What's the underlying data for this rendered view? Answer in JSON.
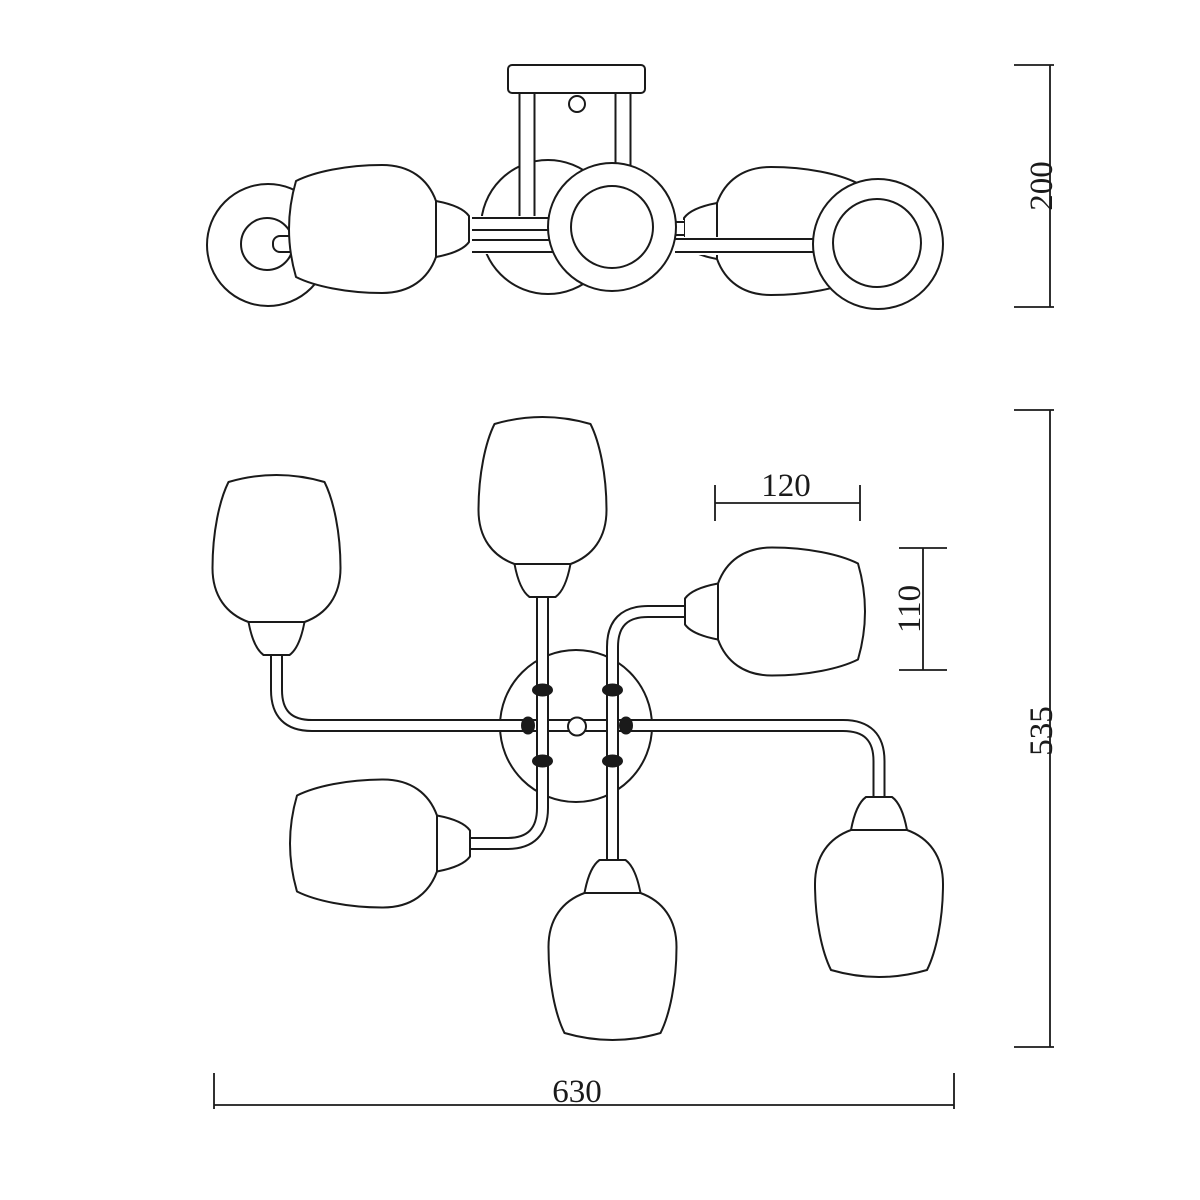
{
  "drawing": {
    "type": "technical-dimension-drawing",
    "subject": "6-light ceiling chandelier, side elevation (top) and plan view (bottom)",
    "colors": {
      "background": "#ffffff",
      "line": "#1a1a1a"
    },
    "views": [
      {
        "id": "side-elevation",
        "position": "top"
      },
      {
        "id": "plan-view",
        "position": "bottom"
      }
    ],
    "dimensions": {
      "fixture_height": {
        "label": "200",
        "orientation": "vertical",
        "applies_to": "side elevation overall height"
      },
      "shade_width": {
        "label": "120",
        "orientation": "horizontal",
        "applies_to": "single shade width (plan)"
      },
      "shade_depth": {
        "label": "110",
        "orientation": "vertical",
        "applies_to": "single shade depth (plan)"
      },
      "plan_depth": {
        "label": "535",
        "orientation": "vertical",
        "applies_to": "plan view overall depth"
      },
      "plan_width": {
        "label": "630",
        "orientation": "horizontal",
        "applies_to": "plan view overall width"
      }
    },
    "parts": {
      "shade_count": 6,
      "canopy": "round ceiling canopy with 4 junction nuts and center finial",
      "arms": 3
    }
  }
}
